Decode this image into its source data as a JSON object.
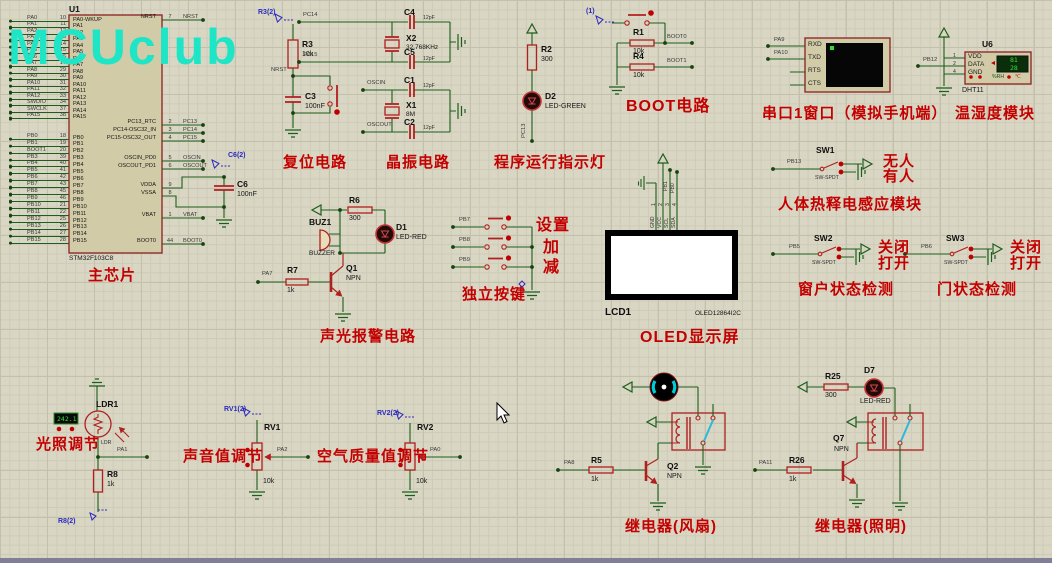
{
  "logo": "MCUclub",
  "mcu": {
    "ref": "U1",
    "part": "STM32F103C8",
    "caption": "主芯片",
    "pa_pins": [
      {
        "net": "PA0",
        "num": "10",
        "name": "PA0-WKUP"
      },
      {
        "net": "PA1",
        "num": "11",
        "name": "PA1"
      },
      {
        "net": "PA2",
        "num": "12",
        "name": "PA2"
      },
      {
        "net": "PA3",
        "num": "13",
        "name": "PA3"
      },
      {
        "net": "PA4",
        "num": "14",
        "name": "PA4"
      },
      {
        "net": "PA5",
        "num": "15",
        "name": "PA5"
      },
      {
        "net": "PA6",
        "num": "16",
        "name": "PA6"
      },
      {
        "net": "PA7",
        "num": "17",
        "name": "PA7"
      },
      {
        "net": "PA8",
        "num": "29",
        "name": "PA8"
      },
      {
        "net": "PA9",
        "num": "30",
        "name": "PA9"
      },
      {
        "net": "PA10",
        "num": "31",
        "name": "PA10"
      },
      {
        "net": "PA11",
        "num": "32",
        "name": "PA11"
      },
      {
        "net": "PA12",
        "num": "33",
        "name": "PA12"
      },
      {
        "net": "SWDIO",
        "num": "34",
        "name": "PA13"
      },
      {
        "net": "SWCLK",
        "num": "37",
        "name": "PA14"
      },
      {
        "net": "PA15",
        "num": "38",
        "name": "PA15"
      }
    ],
    "pb_pins": [
      {
        "net": "PB0",
        "num": "18",
        "name": "PB0"
      },
      {
        "net": "PB1",
        "num": "19",
        "name": "PB1"
      },
      {
        "net": "BOOT1",
        "num": "20",
        "name": "PB2"
      },
      {
        "net": "PB3",
        "num": "39",
        "name": "PB3"
      },
      {
        "net": "PB4",
        "num": "40",
        "name": "PB4"
      },
      {
        "net": "PB5",
        "num": "41",
        "name": "PB5"
      },
      {
        "net": "PB6",
        "num": "42",
        "name": "PB6"
      },
      {
        "net": "PB7",
        "num": "43",
        "name": "PB7"
      },
      {
        "net": "PB8",
        "num": "45",
        "name": "PB8"
      },
      {
        "net": "PB9",
        "num": "46",
        "name": "PB9"
      },
      {
        "net": "PB10",
        "num": "21",
        "name": "PB10"
      },
      {
        "net": "PB11",
        "num": "22",
        "name": "PB11"
      },
      {
        "net": "PB12",
        "num": "25",
        "name": "PB12"
      },
      {
        "net": "PB13",
        "num": "26",
        "name": "PB13"
      },
      {
        "net": "PB14",
        "num": "27",
        "name": "PB14"
      },
      {
        "net": "PB15",
        "num": "28",
        "name": "PB15"
      }
    ],
    "right_pins": [
      {
        "name": "NRST",
        "num": "7",
        "net": "NRST"
      },
      {
        "name": "PC13_RTC",
        "num": "2",
        "net": "PC13"
      },
      {
        "name": "PC14-OSC32_IN",
        "num": "3",
        "net": "PC14"
      },
      {
        "name": "PC15-OSC32_OUT",
        "num": "4",
        "net": "PC15"
      },
      {
        "name": "OSCIN_PD0",
        "num": "5",
        "net": "OSCIN"
      },
      {
        "name": "OSCOUT_PD1",
        "num": "6",
        "net": "OSCOUT"
      },
      {
        "name": "VDDA",
        "num": "9",
        "net": ""
      },
      {
        "name": "VSSA",
        "num": "8",
        "net": ""
      },
      {
        "name": "VBAT",
        "num": "1",
        "net": "VBAT"
      },
      {
        "name": "BOOT0",
        "num": "44",
        "net": "BOOT0"
      }
    ],
    "c6": {
      "ref": "C6",
      "val": "100nF",
      "probe": "C6(2)"
    }
  },
  "reset": {
    "caption": "复位电路",
    "probe": "R3(2)",
    "r_ref": "R3",
    "r_val": "10k",
    "net": "NRST",
    "c_ref": "C3",
    "c_val": "100nF"
  },
  "crystal": {
    "caption": "晶振电路",
    "net_pc14": "PC14",
    "net_pc15": "PC15",
    "net_oscin": "OSCIN",
    "net_oscout": "OSCOUT",
    "c4": {
      "ref": "C4",
      "val": "12pF"
    },
    "c5": {
      "ref": "C5",
      "val": "12pF"
    },
    "c1": {
      "ref": "C1",
      "val": "12pF"
    },
    "c2": {
      "ref": "C2",
      "val": "12pF"
    },
    "x2": {
      "ref": "X2",
      "val": "32.768KHz"
    },
    "x1": {
      "ref": "X1",
      "val": "8M"
    }
  },
  "runled": {
    "caption": "程序运行指示灯",
    "r_ref": "R2",
    "r_val": "300",
    "d_ref": "D2",
    "d_val": "LED-GREEN",
    "net": "PC13"
  },
  "boot": {
    "caption": "BOOT电路",
    "probe": "(1)",
    "r1_ref": "R1",
    "r1_val": "10k",
    "net0": "BOOT0",
    "r4_ref": "R4",
    "r4_val": "10k",
    "net1": "BOOT1"
  },
  "serial": {
    "caption": "串口1窗口（模拟手机端）",
    "pins": [
      "RXD",
      "TXD",
      "RTS",
      "CTS"
    ],
    "net_rx": "PA9",
    "net_tx": "PA10"
  },
  "dht": {
    "caption": "温湿度模块",
    "ref": "U6",
    "part": "DHT11",
    "pin_nums": [
      "1",
      "2",
      "4"
    ],
    "pin_names": [
      "VDD",
      "DATA",
      "GND"
    ],
    "net": "PB12",
    "humidity": "81",
    "temperature": "28",
    "unit_rh": "%RH",
    "unit_c": "℃"
  },
  "pir": {
    "caption": "人体热释电感应模块",
    "ref": "SW1",
    "part": "SW-SPDT",
    "net": "PB13",
    "state_hi": "无人",
    "state_lo": "有人"
  },
  "window_sw": {
    "caption": "窗户状态检测",
    "ref": "SW2",
    "part": "SW-SPDT",
    "net": "PB5",
    "state_hi": "关闭",
    "state_lo": "打开"
  },
  "door_sw": {
    "caption": "门状态检测",
    "ref": "SW3",
    "part": "SW-SPDT",
    "net": "PB6",
    "state_hi": "关闭",
    "state_lo": "打开"
  },
  "alarm": {
    "caption": "声光报警电路",
    "buz_ref": "BUZ1",
    "buz_part": "BUZZER",
    "r6_ref": "R6",
    "r6_val": "300",
    "d_ref": "D1",
    "d_val": "LED-RED",
    "net": "PA7",
    "r7_ref": "R7",
    "r7_val": "1k",
    "q_ref": "Q1",
    "q_val": "NPN"
  },
  "keys": {
    "caption": "独立按键",
    "rows": [
      {
        "net": "PB7",
        "label": "设置"
      },
      {
        "net": "PB8",
        "label": "加"
      },
      {
        "net": "PB9",
        "label": "减"
      }
    ]
  },
  "oled": {
    "caption": "OLED显示屏",
    "ref": "LCD1",
    "part": "OLED12864I2C",
    "pins": [
      "GND",
      "VCC",
      "SCL",
      "SDA"
    ],
    "pin_nums": [
      "1",
      "2",
      "3",
      "4"
    ],
    "net_scl": "PB1",
    "net_sda": "PB0"
  },
  "light_sensor": {
    "caption": "光照调节",
    "ref": "LDR1",
    "part": "LDR",
    "reading": "242.1",
    "net": "PA1",
    "r_ref": "R8",
    "r_val": "1k",
    "probe": "R8(2)"
  },
  "sound_pot": {
    "caption": "声音值调节",
    "probe": "RV1(2)",
    "ref": "RV1",
    "val": "10k",
    "net": "PA2"
  },
  "air_pot": {
    "caption": "空气质量值调节",
    "probe": "RV2(2)",
    "ref": "RV2",
    "val": "10k",
    "net": "PA0"
  },
  "fan_relay": {
    "caption": "继电器(风扇)",
    "net": "PA8",
    "r_ref": "R5",
    "r_val": "1k",
    "q_ref": "Q2",
    "q_val": "NPN"
  },
  "light_relay": {
    "caption": "继电器(照明)",
    "r25_ref": "R25",
    "r25_val": "300",
    "d_ref": "D7",
    "d_val": "LED-RED",
    "net": "PA11",
    "r26_ref": "R26",
    "r26_val": "1k",
    "q_ref": "Q7",
    "q_val": "NPN"
  }
}
